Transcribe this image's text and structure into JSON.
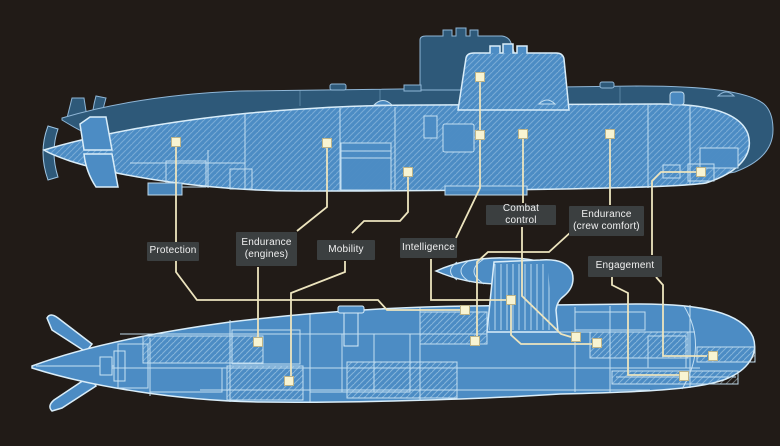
{
  "diagram": {
    "description": "Comparison diagram of two submarines with capability callouts",
    "colors": {
      "background": "#211B17",
      "hull_light": "#4C8CC4",
      "hull_dark": "#2E5979",
      "outline": "#D9EDF9",
      "internal_line": "#C9E3F4",
      "leader_line": "#ECE4BE",
      "marker_fill": "#F8F4D2",
      "marker_stroke": "#BDB489",
      "label_bg": "#3B3F40",
      "label_text": "#F1F1F1"
    }
  },
  "callouts": [
    {
      "id": "protection",
      "line1": "Protection",
      "line2": ""
    },
    {
      "id": "endurance-engines",
      "line1": "Endurance",
      "line2": "(engines)"
    },
    {
      "id": "mobility",
      "line1": "Mobility",
      "line2": ""
    },
    {
      "id": "intelligence",
      "line1": "Intelligence",
      "line2": ""
    },
    {
      "id": "combat-control",
      "line1": "Combat control",
      "line2": ""
    },
    {
      "id": "endurance-crew",
      "line1": "Endurance",
      "line2": "(crew comfort)"
    },
    {
      "id": "engagement",
      "line1": "Engagement",
      "line2": ""
    }
  ],
  "markers": [
    {
      "name": "protection-top",
      "x": 176,
      "y": 142
    },
    {
      "name": "endurance-engines-top",
      "x": 327,
      "y": 143
    },
    {
      "name": "mobility-top",
      "x": 408,
      "y": 172
    },
    {
      "name": "intelligence-sail-top",
      "x": 480,
      "y": 77
    },
    {
      "name": "intelligence-hull-top",
      "x": 480,
      "y": 135
    },
    {
      "name": "combat-control-top",
      "x": 523,
      "y": 134
    },
    {
      "name": "endurance-crew-top",
      "x": 610,
      "y": 134
    },
    {
      "name": "engagement-top",
      "x": 701,
      "y": 172
    },
    {
      "name": "protection-bottom",
      "x": 465,
      "y": 310
    },
    {
      "name": "endurance-engines-bottom",
      "x": 258,
      "y": 342
    },
    {
      "name": "mobility-bottom",
      "x": 289,
      "y": 381
    },
    {
      "name": "intelligence-sail-bottom",
      "x": 511,
      "y": 300
    },
    {
      "name": "intelligence-bottom",
      "x": 597,
      "y": 343
    },
    {
      "name": "combat-control-bottom",
      "x": 576,
      "y": 337
    },
    {
      "name": "endurance-crew-bottom",
      "x": 475,
      "y": 341
    },
    {
      "name": "engagement-bottom-1",
      "x": 713,
      "y": 356
    },
    {
      "name": "engagement-bottom-2",
      "x": 684,
      "y": 376
    }
  ],
  "leader_lines": [
    {
      "id": "protection",
      "points": "176,146 176,272 197,300 378,300 387,310 460,310"
    },
    {
      "id": "endurance-engines-up",
      "points": "327,147 327,207 297,231"
    },
    {
      "id": "endurance-engines-dn",
      "points": "258,267 258,338"
    },
    {
      "id": "mobility-up",
      "points": "408,176 408,212 400,221 364,221 352,233"
    },
    {
      "id": "mobility-dn",
      "points": "345,261 345,272 291,293 291,377"
    },
    {
      "id": "intelligence-up",
      "points": "480,81 480,188 456,238"
    },
    {
      "id": "intelligence-dn",
      "points": "431,259 431,300 506,300"
    },
    {
      "id": "intelligence-chain",
      "points": "511,304 511,335 521,344 592,344"
    },
    {
      "id": "combat-up",
      "points": "523,138 523,203"
    },
    {
      "id": "combat-dn",
      "points": "522,227 522,296 561,334 571,337"
    },
    {
      "id": "crew-up",
      "points": "610,138 610,205"
    },
    {
      "id": "crew-dn",
      "points": "572,231 549,252 488,252 477,262 477,337"
    },
    {
      "id": "engagement-up",
      "points": "697,172 661,172 652,181 652,255"
    },
    {
      "id": "engagement-dn1",
      "points": "656,277 663,285 663,356 707,356"
    },
    {
      "id": "engagement-dn2",
      "points": "612,277 612,285 628,293 628,375 679,375"
    }
  ]
}
